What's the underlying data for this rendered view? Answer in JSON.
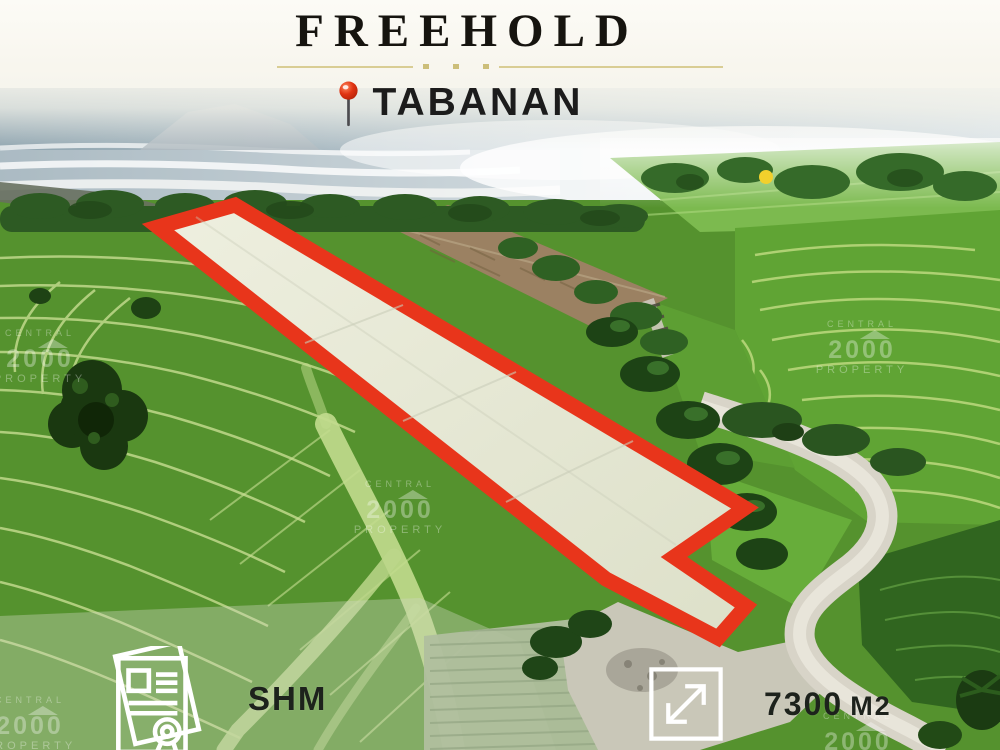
{
  "header": {
    "title": "FREEHOLD",
    "location": "TABANAN"
  },
  "footer": {
    "certificate": "SHM",
    "area_value": "7300",
    "area_unit": "M2"
  },
  "watermark": {
    "line1": "CENTRAL",
    "line2": "2000",
    "line3": "PROPERTY"
  },
  "icons": {
    "location_pin": "push-pin-icon",
    "certificate": "land-certificate-document-icon",
    "area": "expand-diagonal-arrows-icon"
  },
  "colors": {
    "plot_outline_red": "#e8351b",
    "plot_fill": "#e7e9d7",
    "accent_gold": "#d9cd94",
    "pin_red": "#e03312",
    "text_dark": "#1b1b1b",
    "sun_glint_yellow": "#f2d02c"
  }
}
